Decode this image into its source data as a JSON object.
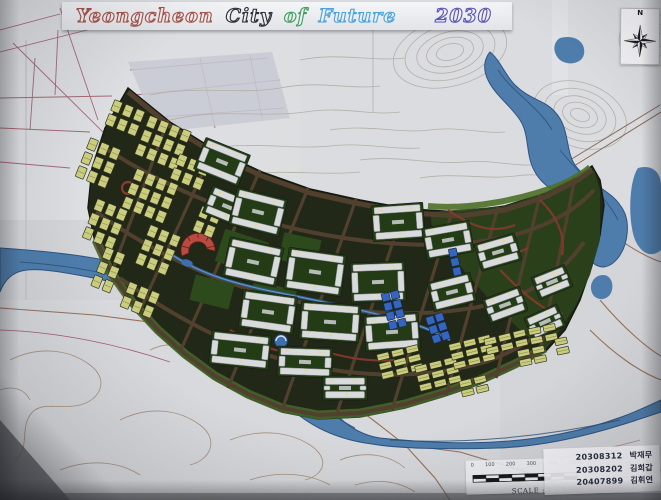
{
  "banner": {
    "title_segments": [
      {
        "text": "Yeongcheon",
        "color": "#a4524a"
      },
      {
        "text": "City",
        "color": "#2e2e38"
      },
      {
        "text": "of",
        "color": "#3f9e5f"
      },
      {
        "text": "Future",
        "color": "#4aa3e0"
      },
      {
        "text": "2030",
        "color": "#5b55b8"
      }
    ]
  },
  "compass": {
    "label": "N",
    "icon": "compass-rose-icon"
  },
  "scale_card": {
    "label": "SCALE : 1 / 3,000",
    "ticks": [
      "0",
      "100",
      "200",
      "300",
      "400",
      "500m"
    ]
  },
  "credits": [
    {
      "id": "20308312",
      "name": "박재무"
    },
    {
      "id": "20308202",
      "name": "김희갑"
    },
    {
      "id": "20407899",
      "name": "김휘연"
    }
  ],
  "palette": {
    "paper": "#d4d5d9",
    "paper_light": "#e1e2e5",
    "terrain_contour": "#b3b0a6",
    "cadastral_line": "#a15c6b",
    "map_contour_brown": "#a8907c",
    "map_road": "#96705c",
    "river_fill": "#4e7dac",
    "river_streak": "#2b5078",
    "city_base": "#222818",
    "city_road": "#52402e",
    "edge_green": "#45652a",
    "park_green": "#2c4a1c",
    "block_yellow": "#c9cd7d",
    "block_white": "#d8dadc",
    "block_red": "#bf4f49",
    "block_blue": "#3565bd",
    "tree_yellow": "#cdc253",
    "path_red": "#83392c",
    "pool_blue": "#3f6fae"
  }
}
